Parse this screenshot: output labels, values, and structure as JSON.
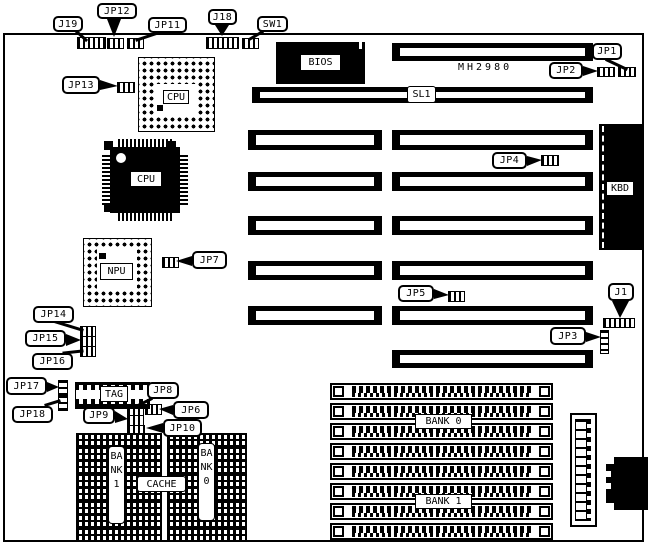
{
  "board": {
    "model": "MH2980",
    "colors": {
      "ink": "#000000",
      "background": "#ffffff"
    }
  },
  "chips": {
    "bios": "BIOS",
    "cpu_socket": "CPU",
    "cpu_qfp": "CPU",
    "npu_socket": "NPU",
    "keyboard_controller": "KBD",
    "tag_ram": "TAG",
    "cache": "CACHE",
    "cache_bank_1": "BANK1",
    "cache_bank_0": "BANK0"
  },
  "slots": {
    "sl1": "SL1"
  },
  "memory": {
    "simm_bank_0": "BANK 0",
    "simm_bank_1": "BANK 1"
  },
  "callouts": {
    "j19": "J19",
    "jp12": "JP12",
    "jp11": "JP11",
    "j18": "J18",
    "sw1": "SW1",
    "jp13": "JP13",
    "jp1": "JP1",
    "jp2": "JP2",
    "jp4": "JP4",
    "jp7": "JP7",
    "jp5": "JP5",
    "j1": "J1",
    "jp3": "JP3",
    "jp14": "JP14",
    "jp15": "JP15",
    "jp16": "JP16",
    "jp17": "JP17",
    "jp18": "JP18",
    "jp8": "JP8",
    "jp6": "JP6",
    "jp9": "JP9",
    "jp10": "JP10"
  }
}
